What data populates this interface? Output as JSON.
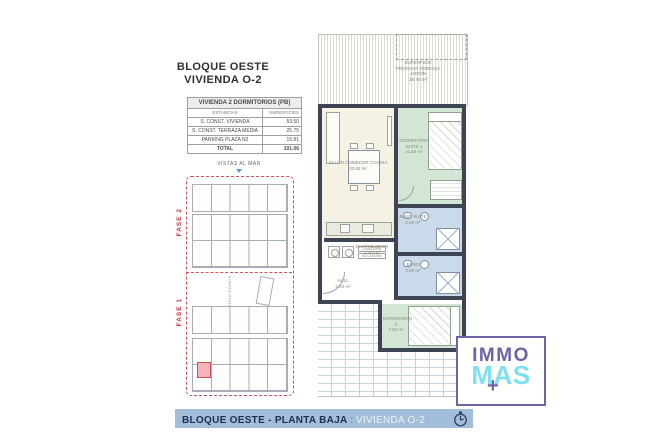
{
  "header": {
    "line1": "BLOQUE OESTE",
    "line2": "VIVIENDA O-2"
  },
  "area_table": {
    "title": "VIVIENDA 2 DORMITORIOS (PB)",
    "col1": "ESTANCIAS",
    "col2": "SUPERFICIES",
    "rows": [
      {
        "label": "S. CONST. VIVIENDA",
        "value": "59.50"
      },
      {
        "label": "S. CONST. TERRAZA MEDIA",
        "value": "25.75"
      },
      {
        "label": "PARKING PLAZA N2",
        "value": "15.81"
      }
    ],
    "total": {
      "label": "TOTAL",
      "value": "101.06"
    }
  },
  "site_plan": {
    "vistas": "VISTAS AL MAR",
    "fase2": "FASE 2",
    "fase1": "FASE 1",
    "zona": "ZONA COMÚN"
  },
  "floor_plan": {
    "terrace": {
      "l1": "SUPERFICIE",
      "l2": "PRIVATIVA TERRAZA",
      "l3": "JARDÍN",
      "area": "25.75 m²"
    },
    "salon": {
      "name": "SALÓN COMEDOR COCINA",
      "area": "20.85 m²"
    },
    "suite": {
      "name": "DORMITORIO SUITE 1",
      "area": "11.50 m²"
    },
    "bano_suite": {
      "name": "BAÑO SUITE",
      "area": "3.80 m²"
    },
    "bano": {
      "name": "BAÑO",
      "area": "3.85 m²"
    },
    "distribuidor": {
      "name": "DISTRIBUIDOR",
      "area": "1.50 m²"
    },
    "hall": {
      "name": "HALL",
      "area": "2.20 m²"
    },
    "dorm2": {
      "name": "DORMITORIO 2",
      "area": "7.60 m²"
    },
    "lavadora": "LAVADORA",
    "secadora": "SECADORA",
    "marker": "O-2"
  },
  "footer": {
    "bold": "BLOQUE OESTE - PLANTA BAJA",
    "sep": " : ",
    "light": "VIVIENDA O-2"
  },
  "logo": {
    "top": "IMMO",
    "bottom": "MAS",
    "plus": "+"
  },
  "colors": {
    "banner_bg": "#a3bed8",
    "banner_text_dark": "#1e2f55",
    "wall": "#3e4453",
    "room_cream": "#f5f1e3",
    "room_green": "#d3e5d4",
    "room_blue": "#cadaeb",
    "fase_red": "#c43a40",
    "marker_blue": "#4a8fd0",
    "logo_purple": "#6e63aa",
    "logo_cyan": "#7fe1ef"
  }
}
